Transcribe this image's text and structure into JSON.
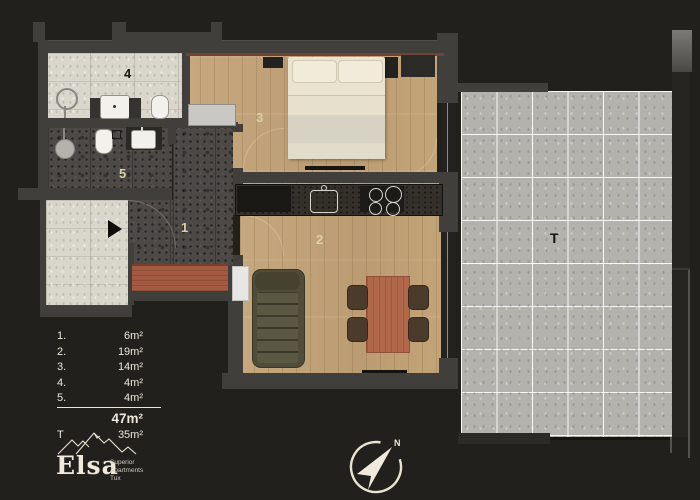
{
  "plan": {
    "rooms": {
      "hall": "1",
      "living_kitchen": "2",
      "bedroom": "3",
      "bathroom": "4",
      "wc": "5",
      "terrace": "T"
    }
  },
  "legend": {
    "rows": [
      {
        "label": "1.",
        "value": "6m²"
      },
      {
        "label": "2.",
        "value": "19m²"
      },
      {
        "label": "3.",
        "value": "14m²"
      },
      {
        "label": "4.",
        "value": "4m²"
      },
      {
        "label": "5.",
        "value": "4m²"
      }
    ],
    "total": {
      "value": "47m²"
    },
    "terrace": {
      "label": "T",
      "value": "35m²"
    }
  },
  "branding": {
    "name": "Elsa",
    "tagline_lines": [
      "Superior",
      "Apartments",
      "Tux"
    ]
  },
  "compass": {
    "north_label": "N"
  },
  "colors": {
    "background": "#21201d",
    "wall": "#413f3c",
    "cream_text": "#eae7da",
    "room_number": "#d9d1a2",
    "wood_floor": "#c2a379",
    "dark_stone_floor": "#4c4946",
    "light_tile_floor": "#d9d6cb",
    "terrace_tile": "#b4b2ad",
    "sofa": "#4f4c3a",
    "table": "#b1684a",
    "sideboard": "#a45a40"
  }
}
